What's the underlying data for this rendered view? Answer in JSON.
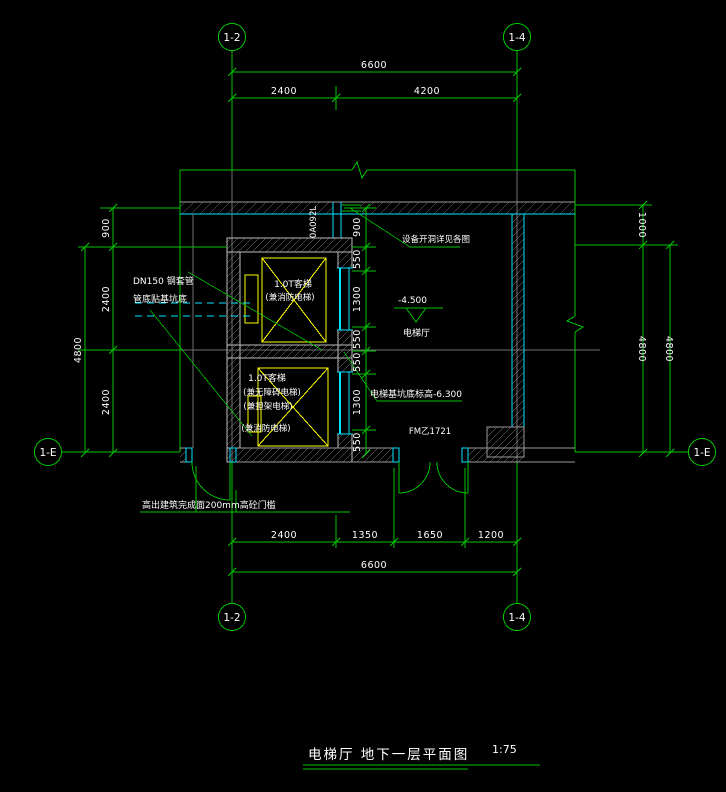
{
  "drawing": {
    "title": "电梯厅  地下一层平面图",
    "scale": "1:75"
  },
  "grid_bubbles": {
    "top_left": "1-2",
    "top_right": "1-4",
    "bottom_left": "1-2",
    "bottom_right": "1-4",
    "left_row": "1-E",
    "right_row": "1-E"
  },
  "dimensions": {
    "top_total": "6600",
    "top_segments": [
      "2400",
      "4200"
    ],
    "bottom_segments": [
      "2400",
      "1350",
      "1650",
      "1200"
    ],
    "bottom_total": "6600",
    "left_segments": [
      "900",
      "2400",
      "2400"
    ],
    "left_total": "4800",
    "right_top": "1000",
    "right_inner_total": "4800",
    "right_outer_total": "4800",
    "shaft_chain": [
      "900",
      "550",
      "1300",
      "550",
      "550",
      "1300",
      "550"
    ]
  },
  "annotations": {
    "pipe_line1": "DN150 钢套管",
    "pipe_line2": "管底贴基坑底",
    "equipment_note": "设备开洞详见各图",
    "floor_level": "-4.500",
    "room_label": "电梯厅",
    "pit_level_note": "电梯基坑底标高-6.300",
    "door_tag": "FM乙1721",
    "threshold_note": "高出建筑完成面200mm高砼门槛",
    "duct_tag": "0A092L",
    "elevator_top": [
      "1.0T客梯",
      "(兼消防电梯)"
    ],
    "elevator_bottom": [
      "1.0T客梯",
      "(兼无障碍电梯)",
      "(兼担架电梯)",
      "(兼消防电梯)"
    ]
  },
  "colors": {
    "background": "#000000",
    "line_green": "#00c400",
    "line_cyan": "#00e5ff",
    "line_yellow": "#ffff00",
    "text_white": "#ffffff",
    "hatch_gray": "#9a9a9a"
  }
}
